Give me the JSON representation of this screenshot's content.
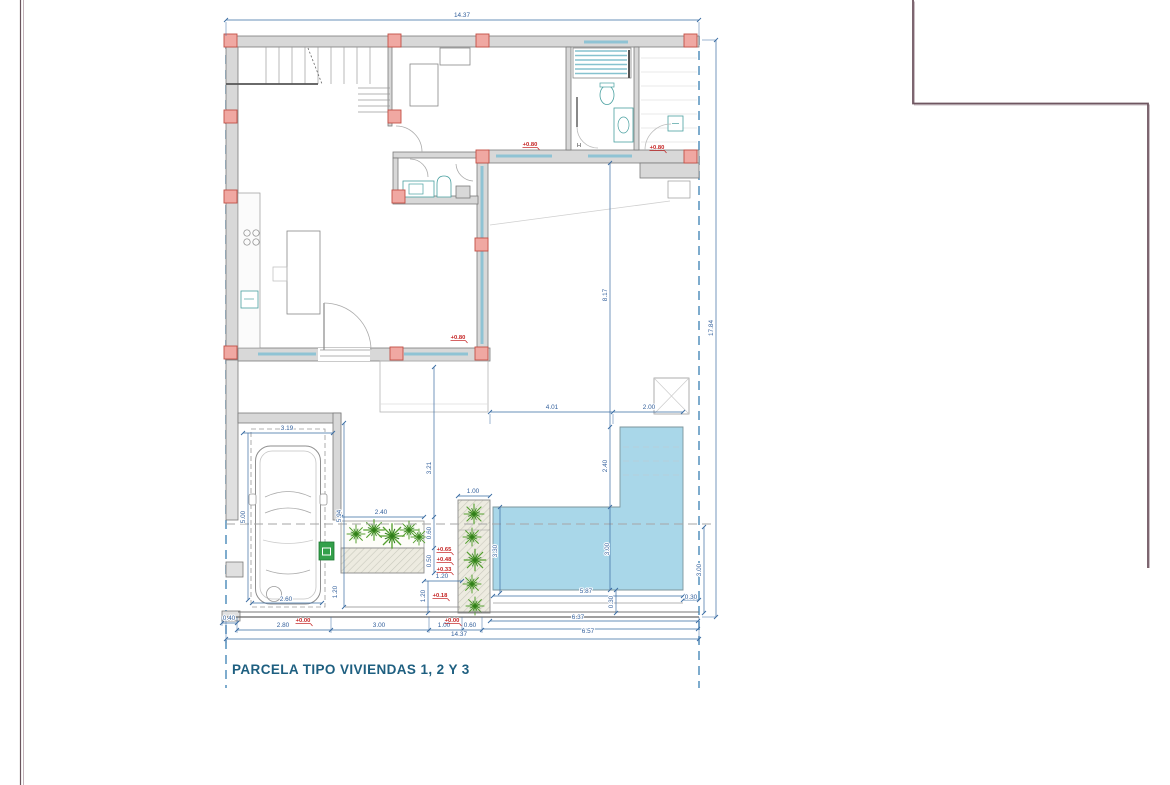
{
  "drawing": {
    "title": "PARCELA TIPO VIVIENDAS 1, 2 Y 3",
    "type": "architectural-site-plan",
    "colors": {
      "dimension_text": "#33609c",
      "level_mark": "#c42121",
      "title_text": "#1e5f80",
      "pool_fill": "#a9d7e9",
      "wall_fill": "#d8d8d8",
      "column_fill": "#f0a8a2",
      "boundary_dash": "#4788b8",
      "plant_green": "#55a02f",
      "frame_line": "#6f5660",
      "glass_line": "#8fc3d4",
      "gate_box_green": "#33a04a"
    },
    "dim_labels": [
      {
        "t": "14.37",
        "x": 462,
        "y": 17
      },
      {
        "t": "17.84",
        "x": 713,
        "y": 328,
        "r": -90
      },
      {
        "t": "8.17",
        "x": 607,
        "y": 295,
        "r": -90
      },
      {
        "t": "2.40",
        "x": 607,
        "y": 466,
        "r": -90
      },
      {
        "t": "3.00",
        "x": 609,
        "y": 549,
        "r": -90
      },
      {
        "t": "4.01",
        "x": 552,
        "y": 409
      },
      {
        "t": "2.00",
        "x": 649,
        "y": 409
      },
      {
        "t": "3.30",
        "x": 497,
        "y": 551,
        "r": -90
      },
      {
        "t": "5.87",
        "x": 586,
        "y": 593
      },
      {
        "t": "0.30",
        "x": 691,
        "y": 599,
        "s": 5
      },
      {
        "t": "0.30",
        "x": 613,
        "y": 602,
        "r": -90,
        "s": 5
      },
      {
        "t": "3.00",
        "x": 701,
        "y": 570,
        "r": -90
      },
      {
        "t": "3.19",
        "x": 287,
        "y": 430
      },
      {
        "t": "5.00",
        "x": 245,
        "y": 517,
        "r": -90
      },
      {
        "t": "5.94",
        "x": 341,
        "y": 516,
        "r": -90
      },
      {
        "t": "2.60",
        "x": 286,
        "y": 601
      },
      {
        "t": "3.21",
        "x": 431,
        "y": 468,
        "r": -90
      },
      {
        "t": "2.40",
        "x": 381,
        "y": 514
      },
      {
        "t": "1.00",
        "x": 473,
        "y": 493
      },
      {
        "t": "0.60",
        "x": 431,
        "y": 533,
        "r": -90,
        "s": 5
      },
      {
        "t": "0.50",
        "x": 431,
        "y": 561,
        "r": -90,
        "s": 5
      },
      {
        "t": "1.20",
        "x": 442,
        "y": 578
      },
      {
        "t": "1.20",
        "x": 337,
        "y": 592,
        "r": -90,
        "s": 5
      },
      {
        "t": "1.20",
        "x": 425,
        "y": 596,
        "r": -90,
        "s": 5
      },
      {
        "t": "0.40",
        "x": 229,
        "y": 620,
        "s": 5.5
      },
      {
        "t": "2.80",
        "x": 283,
        "y": 627
      },
      {
        "t": "3.00",
        "x": 379,
        "y": 627
      },
      {
        "t": "1.00",
        "x": 444,
        "y": 627
      },
      {
        "t": "0.60",
        "x": 470,
        "y": 627,
        "s": 5.5
      },
      {
        "t": "6.37",
        "x": 578,
        "y": 619
      },
      {
        "t": "6.57",
        "x": 588,
        "y": 633
      },
      {
        "t": "14.37",
        "x": 459,
        "y": 636
      }
    ],
    "level_labels": [
      {
        "t": "+0.80",
        "x": 530,
        "y": 146
      },
      {
        "t": "+0.80",
        "x": 657,
        "y": 149
      },
      {
        "t": "+0.80",
        "x": 458,
        "y": 339
      },
      {
        "t": "+0.00",
        "x": 303,
        "y": 622
      },
      {
        "t": "+0.00",
        "x": 452,
        "y": 622
      },
      {
        "t": "+0.65",
        "x": 444,
        "y": 551
      },
      {
        "t": "+0.48",
        "x": 444,
        "y": 561
      },
      {
        "t": "+0.33",
        "x": 444,
        "y": 571
      },
      {
        "t": "+0.18",
        "x": 440,
        "y": 597
      }
    ],
    "misc_labels": [
      {
        "t": "H",
        "x": 579,
        "y": 147
      }
    ]
  }
}
